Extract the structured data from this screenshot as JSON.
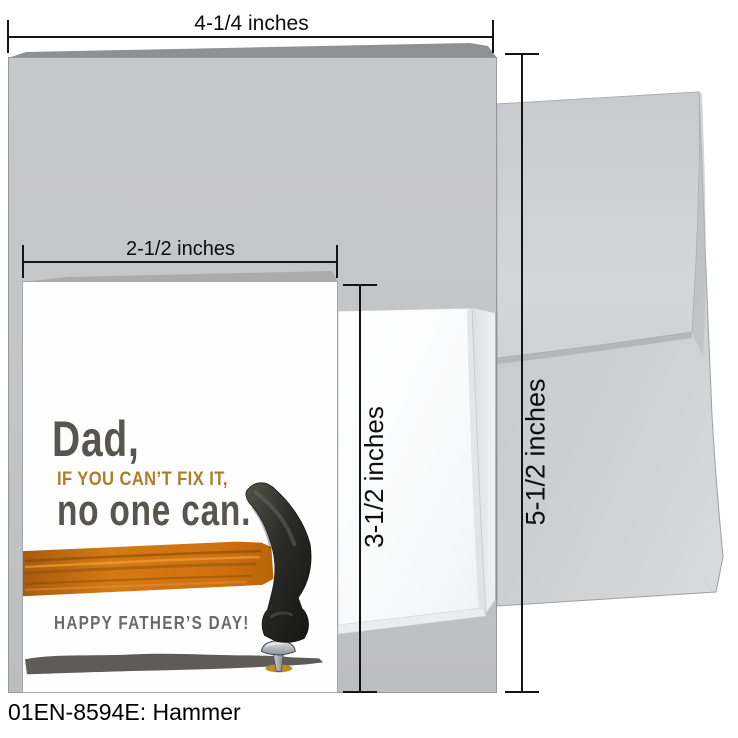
{
  "page": {
    "caption": "01EN-8594E: Hammer"
  },
  "dimensions": {
    "large_card_width": "4-1/4 inches",
    "small_card_width": "2-1/2 inches",
    "small_card_height": "3-1/2 inches",
    "envelope_height": "5-1/2 inches"
  },
  "card": {
    "line1": "Dad,",
    "line2": "IF YOU CAN’T FIX IT,",
    "line3": "no one can.",
    "line4": "HAPPY FATHER’S DAY!"
  },
  "colors": {
    "card_stock_gray": "#c4c5c7",
    "envelope_gray": "#cdcfd1",
    "card_text_dark": "#57554f",
    "card_text_gold": "#ac7e2b",
    "card_text_gray": "#6c6a64",
    "hammer_handle_orange": "#d1760f",
    "hammer_head_black": "#2b2b27",
    "ground_shadow_gray": "#5d5c59",
    "nail_base_gold": "#c28b1e",
    "measurement_line_black": "#141414"
  }
}
